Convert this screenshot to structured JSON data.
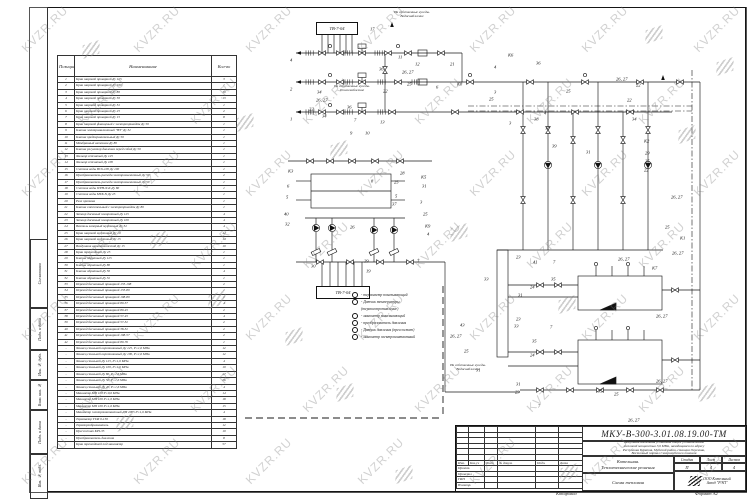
{
  "watermark": {
    "text": "KVZR.RU"
  },
  "frame": {
    "footer_left": "Копировал",
    "footer_right": "Формат А2",
    "side_labels": [
      "Согласовано",
      "Подп. и дата",
      "Инв. № дубл.",
      "Взам. инв. №",
      "Подп. и дата",
      "Инв. № подл."
    ]
  },
  "parts_table": {
    "headers": {
      "position": "Позиция",
      "name": "Наименование",
      "qty": "Кол-во"
    },
    "rows": [
      [
        "1",
        "Кран шаровой приварной Ду 125",
        "3"
      ],
      [
        "2",
        "Кран шаровой приварной Ду 100",
        "1"
      ],
      [
        "3",
        "Кран шаровой приварной Ду 80",
        "10"
      ],
      [
        "4",
        "Кран шаровой приварной Ду 50",
        "13"
      ],
      [
        "5",
        "Кран шаровой приварной Ду 32",
        "1"
      ],
      [
        "6",
        "Кран шаровой приварной Ду 25",
        "2"
      ],
      [
        "7",
        "Кран шаровой приварной Ду 15",
        "8"
      ],
      [
        "8",
        "Кран шаровой фланцевый с электроприводом Ду 50",
        "1"
      ],
      [
        "9",
        "Клапан электромагнитный \"НЗ\" Ду 32",
        "1"
      ],
      [
        "10",
        "Клапан предохранительный Ду 50",
        "1"
      ],
      [
        "11",
        "Мембранный автоклав Ду 80",
        "1"
      ],
      [
        "12",
        "Клапан регулятор давления перед собой Ду 50",
        "1"
      ],
      [
        "13",
        "Фильтр сетчатый Ду 125",
        "1"
      ],
      [
        "14",
        "Фильтр сетчатый Ду 100",
        "1"
      ],
      [
        "15",
        "Счетчик воды ВСХ-100 Ду 100",
        "1"
      ],
      [
        "16",
        "Преобразователь расхода электромагнитный Ду 50",
        "2"
      ],
      [
        "17",
        "Преобразователь расхода электромагнитный Ду 50",
        "1"
      ],
      [
        "18",
        "Счетчик воды WPH-N-K Ду 80",
        "1"
      ],
      [
        "19",
        "Счетчик воды МТК-N Ду 25",
        "1"
      ],
      [
        "20",
        "Реле протока",
        "1"
      ],
      [
        "21",
        "Клапан смесительный с электроприводом Ду 80",
        "1"
      ],
      [
        "22",
        "Затвор дисковый поворотный Ду 125",
        "4"
      ],
      [
        "23",
        "Затвор дисковый поворотный Ду 100",
        "4"
      ],
      [
        "24",
        "Вентиль запорный муфтовый Ду 32",
        "4"
      ],
      [
        "25",
        "Кран шаровой муфтовый Ду 20",
        "42"
      ],
      [
        "26",
        "Кран шаровой муфтовый Ду 15",
        "14"
      ],
      [
        "27",
        "Воздушник автоматический Ду 15",
        "10"
      ],
      [
        "28",
        "Кран трехходовой Ду 25",
        "1"
      ],
      [
        "29",
        "Клапан обратный Ду 125",
        "1"
      ],
      [
        "30",
        "Клапан обратный Ду 80",
        "1"
      ],
      [
        "31",
        "Клапан обратный Ду 50",
        "4"
      ],
      [
        "32",
        "Клапан обратный Ду 32",
        "1"
      ],
      [
        "33",
        "Переход бесшовный приварной 133-108",
        "2"
      ],
      [
        "34",
        "Переход бесшовный приварной 133-89",
        "1"
      ],
      [
        "35",
        "Переход бесшовный приварной 108-89",
        "1"
      ],
      [
        "36",
        "Переход бесшовный приварной 89-57",
        "4"
      ],
      [
        "37",
        "Переход бесшовный приварной 89-45",
        "2"
      ],
      [
        "38",
        "Переход бесшовный приварной 57-45",
        "4"
      ],
      [
        "39",
        "Переход бесшовный приварной 57-32",
        "2"
      ],
      [
        "40",
        "Переход бесшовный приварной 38-32",
        "2"
      ],
      [
        "41",
        "Переход бесшовный приварной 108-57",
        "2"
      ],
      [
        "42",
        "Переход бесшовный приварной 89-76",
        "1"
      ],
      [
        "-",
        "Фланец стальной воротниковый Ду 125, Р=1,6 МПа",
        "12"
      ],
      [
        "-",
        "Фланец стальной воротниковый Ду 100, Р=1,6 МПа",
        "12"
      ],
      [
        "-",
        "Фланец стальной Ду 125, Р=1,6 МПа",
        "4"
      ],
      [
        "-",
        "Фланец стальной Ду 100, Р=1,6 МПа",
        "10"
      ],
      [
        "-",
        "Фланец стальной Ду 80, Р=1,6 МПа",
        "27"
      ],
      [
        "-",
        "Фланец стальной Ду 50, Р=1,6 МПа",
        "26"
      ],
      [
        "-",
        "Фланец стальной Ду 40, Р=1,6 МПа",
        "4"
      ],
      [
        "-",
        "Манометр МП 100 Р=0,6 МПа",
        "14"
      ],
      [
        "-",
        "Манометр МП 100 Р=1,0 МПа",
        "18"
      ],
      [
        "-",
        "Манометр МП 100 Р=1,6 МПа",
        "15"
      ],
      [
        "-",
        "Манометр электроконтактный ДМ 2005 Р=1,6 МПа",
        "4"
      ],
      [
        "-",
        "Термометр ТТЖ 0-150",
        "18"
      ],
      [
        "-",
        "Термопреобразователь",
        "12"
      ],
      [
        "-",
        "Прессостат KPI-35",
        "10"
      ],
      [
        "-",
        "Преобразователь давления",
        "8"
      ],
      [
        "-",
        "Кран трехходовой под манометр",
        "57"
      ]
    ]
  },
  "schematic": {
    "boxes": [
      {
        "label": "ТВ-7-04"
      },
      {
        "label": "ТВ-7-04"
      }
    ],
    "notes": [
      "На собственные нужды.\nВодоснабжение",
      "На собственные нужды.\nТеплоснабжение",
      "На собственные нужды.\nВодоснабжение"
    ],
    "legend": [
      {
        "c": true,
        "t": "- термометр показывающий"
      },
      {
        "c": true,
        "t": "- Датчик температуры"
      },
      {
        "c": false,
        "t": "(термосопротивление)"
      },
      {
        "c": true,
        "t": "- манометр показывающий"
      },
      {
        "c": true,
        "t": "- преобразователь давления"
      },
      {
        "c": true,
        "t": "- Датчик давления (прессостат)"
      },
      {
        "c": true,
        "t": "- манометр электроконтактный"
      }
    ],
    "labels": [
      {
        "t": "4",
        "x": 290,
        "y": 60
      },
      {
        "t": "2",
        "x": 290,
        "y": 89
      },
      {
        "t": "1",
        "x": 290,
        "y": 119
      },
      {
        "t": "17",
        "x": 370,
        "y": 29
      },
      {
        "t": "11",
        "x": 398,
        "y": 57
      },
      {
        "t": "12",
        "x": 415,
        "y": 64
      },
      {
        "t": "26, 27",
        "x": 402,
        "y": 72
      },
      {
        "t": "36",
        "x": 379,
        "y": 69
      },
      {
        "t": "34",
        "x": 317,
        "y": 92
      },
      {
        "t": "26, 27",
        "x": 316,
        "y": 100
      },
      {
        "t": "22",
        "x": 383,
        "y": 91
      },
      {
        "t": "25",
        "x": 407,
        "y": 84
      },
      {
        "t": "21",
        "x": 450,
        "y": 64
      },
      {
        "t": "К6",
        "x": 508,
        "y": 55
      },
      {
        "t": "4",
        "x": 494,
        "y": 67
      },
      {
        "t": "6",
        "x": 436,
        "y": 87
      },
      {
        "t": "К8",
        "x": 457,
        "y": 84
      },
      {
        "t": "3",
        "x": 494,
        "y": 92
      },
      {
        "t": "25",
        "x": 489,
        "y": 99
      },
      {
        "t": "34",
        "x": 322,
        "y": 116
      },
      {
        "t": "36",
        "x": 347,
        "y": 107
      },
      {
        "t": "7",
        "x": 354,
        "y": 120
      },
      {
        "t": "13",
        "x": 380,
        "y": 122
      },
      {
        "t": "22",
        "x": 309,
        "y": 109
      },
      {
        "t": "9",
        "x": 350,
        "y": 133
      },
      {
        "t": "10",
        "x": 365,
        "y": 133
      },
      {
        "t": "36",
        "x": 536,
        "y": 63
      },
      {
        "t": "26, 27",
        "x": 616,
        "y": 79
      },
      {
        "t": "25",
        "x": 566,
        "y": 91
      },
      {
        "t": "22",
        "x": 627,
        "y": 100
      },
      {
        "t": "3",
        "x": 509,
        "y": 123
      },
      {
        "t": "38",
        "x": 534,
        "y": 119
      },
      {
        "t": "4",
        "x": 544,
        "y": 113
      },
      {
        "t": "18",
        "x": 545,
        "y": 128
      },
      {
        "t": "39",
        "x": 552,
        "y": 146
      },
      {
        "t": "31",
        "x": 586,
        "y": 152
      },
      {
        "t": "34",
        "x": 632,
        "y": 119
      },
      {
        "t": "К2",
        "x": 644,
        "y": 141
      },
      {
        "t": "29",
        "x": 645,
        "y": 153
      },
      {
        "t": "25",
        "x": 645,
        "y": 161
      },
      {
        "t": "22",
        "x": 644,
        "y": 170
      },
      {
        "t": "26, 27",
        "x": 671,
        "y": 197
      },
      {
        "t": "25",
        "x": 665,
        "y": 227
      },
      {
        "t": "К1",
        "x": 680,
        "y": 238
      },
      {
        "t": "26, 27",
        "x": 672,
        "y": 253
      },
      {
        "t": "К7",
        "x": 652,
        "y": 268
      },
      {
        "t": "К3",
        "x": 288,
        "y": 171
      },
      {
        "t": "6",
        "x": 287,
        "y": 186
      },
      {
        "t": "5",
        "x": 286,
        "y": 197
      },
      {
        "t": "40",
        "x": 284,
        "y": 214
      },
      {
        "t": "32",
        "x": 285,
        "y": 224
      },
      {
        "t": "26",
        "x": 350,
        "y": 227
      },
      {
        "t": "30",
        "x": 311,
        "y": 266
      },
      {
        "t": "29",
        "x": 364,
        "y": 261
      },
      {
        "t": "19",
        "x": 366,
        "y": 271
      },
      {
        "t": "8",
        "x": 371,
        "y": 181
      },
      {
        "t": "28",
        "x": 400,
        "y": 173
      },
      {
        "t": "25",
        "x": 394,
        "y": 182
      },
      {
        "t": "5",
        "x": 395,
        "y": 196
      },
      {
        "t": "37",
        "x": 392,
        "y": 204
      },
      {
        "t": "К5",
        "x": 421,
        "y": 177
      },
      {
        "t": "31",
        "x": 422,
        "y": 186
      },
      {
        "t": "3",
        "x": 420,
        "y": 202
      },
      {
        "t": "25",
        "x": 423,
        "y": 214
      },
      {
        "t": "К9",
        "x": 425,
        "y": 226
      },
      {
        "t": "4",
        "x": 427,
        "y": 234
      },
      {
        "t": "7",
        "x": 417,
        "y": 261
      },
      {
        "t": "33",
        "x": 484,
        "y": 279
      },
      {
        "t": "23",
        "x": 516,
        "y": 257
      },
      {
        "t": "41",
        "x": 533,
        "y": 262
      },
      {
        "t": "7",
        "x": 553,
        "y": 262
      },
      {
        "t": "24",
        "x": 530,
        "y": 287
      },
      {
        "t": "31",
        "x": 518,
        "y": 295
      },
      {
        "t": "35",
        "x": 551,
        "y": 279
      },
      {
        "t": "43",
        "x": 460,
        "y": 325
      },
      {
        "t": "26, 27",
        "x": 450,
        "y": 336
      },
      {
        "t": "25",
        "x": 464,
        "y": 351
      },
      {
        "t": "23",
        "x": 516,
        "y": 319
      },
      {
        "t": "33",
        "x": 514,
        "y": 326
      },
      {
        "t": "7",
        "x": 550,
        "y": 327
      },
      {
        "t": "35",
        "x": 532,
        "y": 341
      },
      {
        "t": "24",
        "x": 530,
        "y": 355
      },
      {
        "t": "31",
        "x": 516,
        "y": 384
      },
      {
        "t": "23",
        "x": 515,
        "y": 392
      },
      {
        "t": "7",
        "x": 538,
        "y": 406
      },
      {
        "t": "25",
        "x": 614,
        "y": 394
      },
      {
        "t": "35",
        "x": 598,
        "y": 391
      },
      {
        "t": "26, 27",
        "x": 656,
        "y": 316
      },
      {
        "t": "26, 27",
        "x": 656,
        "y": 381
      },
      {
        "t": "26, 27",
        "x": 628,
        "y": 420
      },
      {
        "t": "31",
        "x": 476,
        "y": 370
      },
      {
        "t": "26, 27",
        "x": 618,
        "y": 259
      },
      {
        "t": "22",
        "x": 636,
        "y": 85
      }
    ]
  },
  "title_block": {
    "doc_number": "МКУ-В-300-3.01.08.19.00-ТМ",
    "description": [
      "Модульная котельная установка общей установленной",
      "тепловой мощностью 3,6 МВт, находящаяся по адресу",
      "Республика Бурятия, Муйский район, станция Окусикан,",
      "Восточный портал Северомуйского тоннеля"
    ],
    "object_line1": "Котельная.",
    "object_line2": "Теплотехнические решения",
    "sheet_title": "Схема тепловая",
    "stage_headers": [
      "Стадия",
      "Лист",
      "Листов"
    ],
    "stage_values": [
      "П",
      "4",
      "4"
    ],
    "company_line1": "ООО Котельный",
    "company_line2": "Завод \"РЭП\"",
    "stamp": {
      "cols": [
        "Изм.",
        "Кол.уч",
        "Лист",
        "№ докум.",
        "Подп.",
        "Дата"
      ],
      "rows": [
        "Проект.",
        "Проверил",
        "ГИП",
        "Н.контр."
      ]
    }
  }
}
